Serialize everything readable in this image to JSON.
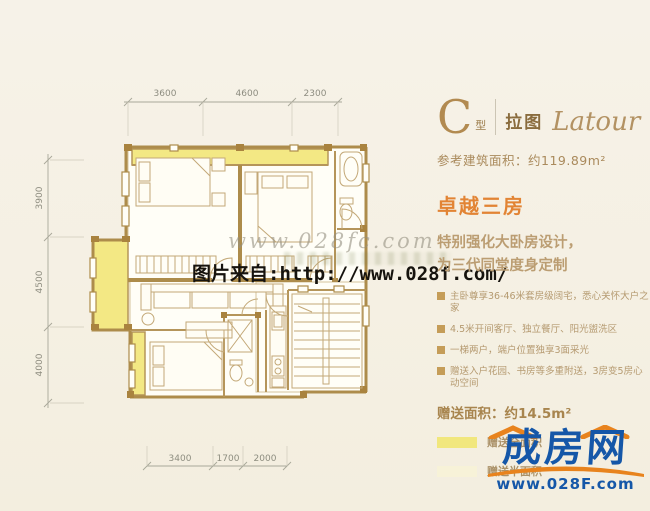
{
  "colors": {
    "background": "#f5f1e6",
    "wall_tan": "#ad8c4b",
    "gift_full_yellow": "#f3e884",
    "gift_half_yellow": "#f7f2d8",
    "panel_gold": "#aa8a5c",
    "headline_orange": "#e28434",
    "logo_blue": "#1557a8",
    "logo_orange": "#e8831d",
    "watermark_black": "#16130e"
  },
  "plan": {
    "dims_top": [
      "3600",
      "4600",
      "2300"
    ],
    "dims_left": [
      "3900",
      "4500",
      "4000"
    ],
    "dims_bottom": [
      "3400",
      "1700",
      "2000"
    ]
  },
  "watermark": {
    "script_line": "www.028fc.com",
    "source_line": "图片来自:http://www.028f.com/"
  },
  "panel": {
    "type_letter": "C",
    "type_suffix": "型",
    "name_cn": "拉图",
    "name_en": "Latour",
    "area_line": "参考建筑面积：约119.89m²",
    "headline": "卓越三房",
    "desc_line1": "特别强化大卧房设计，",
    "desc_line2": "为三代同堂度身定制",
    "bullets": [
      "主卧尊享36-46米套房级阔宅，悉心关怀大户之家",
      "4.5米开间客厅、独立餐厅、阳光盥洗区",
      "一梯两户，端户位置独享3面采光",
      "赠送入户花园、书房等多重附送，3房变5房心动空间"
    ],
    "gift_line": "赠送面积：约14.5m²",
    "legend": [
      {
        "label": "赠送全面积"
      },
      {
        "label": "赠送半面积"
      }
    ]
  },
  "logo": {
    "brand": "成房网",
    "url": "www.028F.com"
  }
}
